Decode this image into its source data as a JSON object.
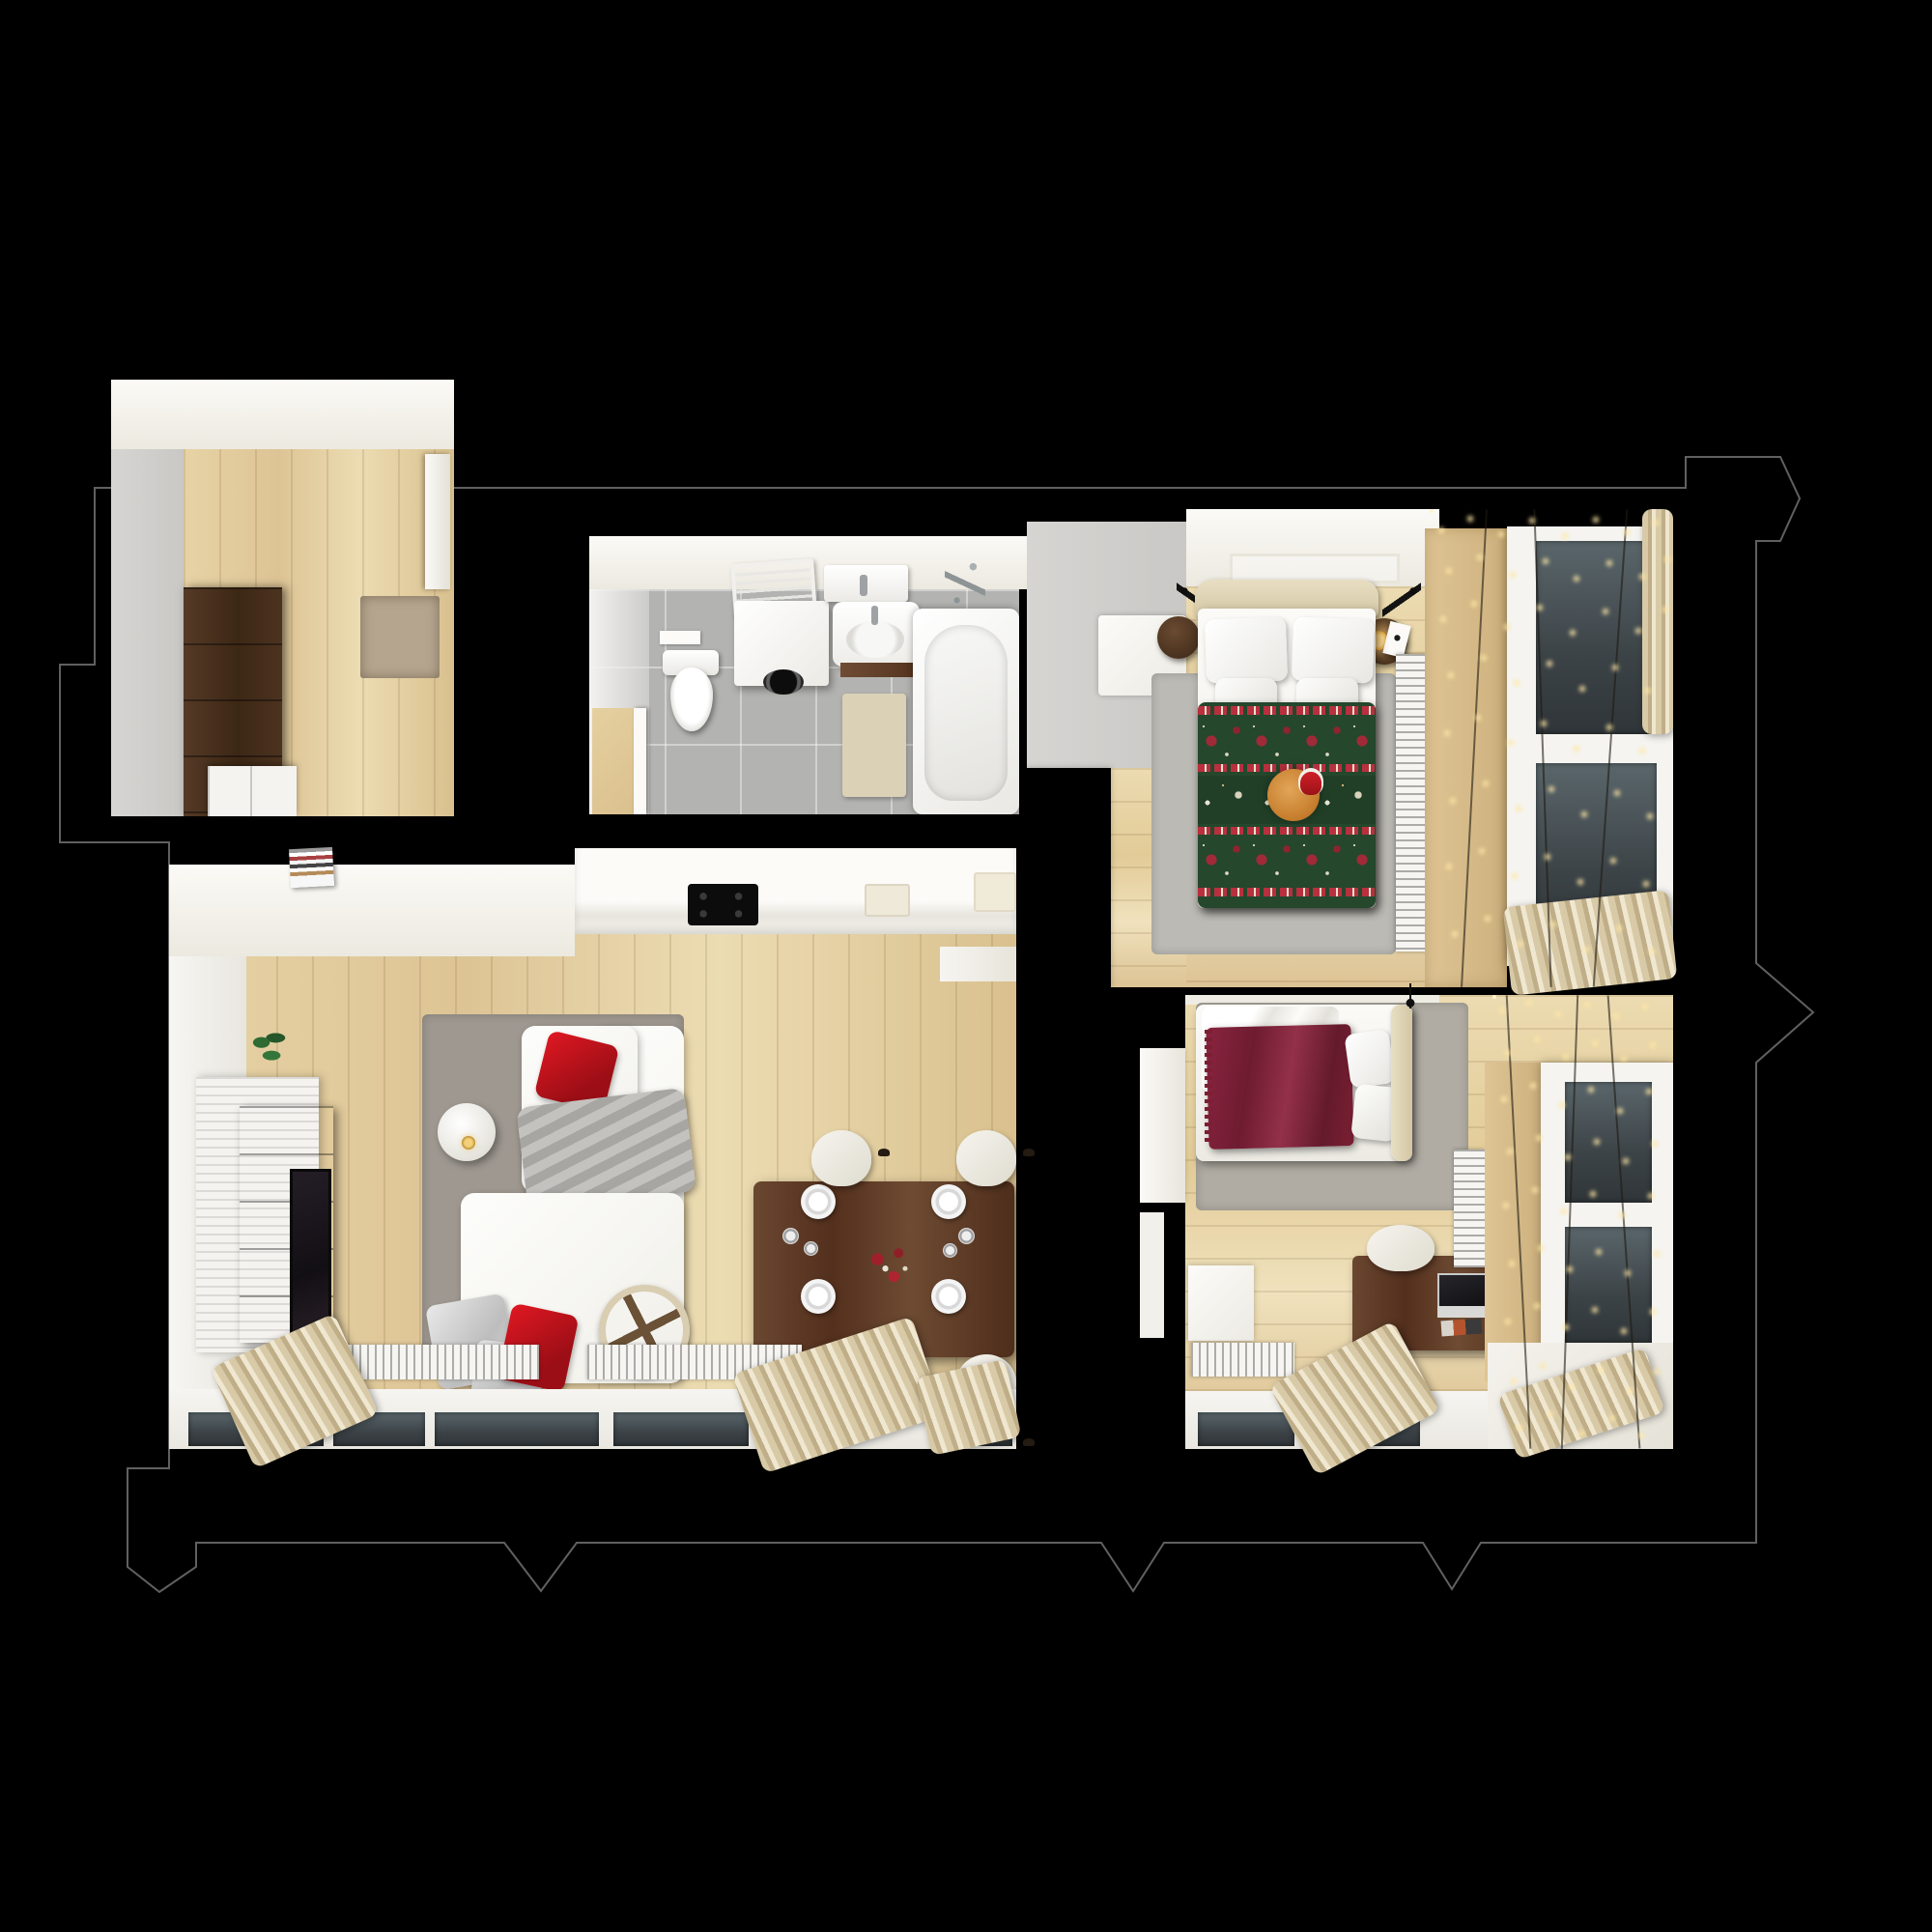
{
  "scene": {
    "type": "3d-floor-plan-top-down-render",
    "theme": "apartment interior with Christmas decor",
    "background_color": "#000000",
    "outline_color": "#606060"
  },
  "palette": {
    "wood_floor": "#e2cb97",
    "gray_tile": "#b3b3b1",
    "walnut_furniture": "#5d3e2a",
    "christmas_green": "#25472c",
    "christmas_red": "#a02a38",
    "burgundy_throw": "#7c1f33",
    "accent_red_pillow": "#c01020",
    "fairy_light_glow": "#ffe7a6",
    "cat_fur": "#d9913f"
  },
  "rooms": [
    {
      "id": "entry-hall",
      "label": "Entry hall",
      "objects": [
        "dark-wood-wardrobe",
        "shoe-cubbies",
        "doormat",
        "wood-floor",
        "gray-floor",
        "door"
      ]
    },
    {
      "id": "bathroom",
      "label": "Bathroom",
      "objects": [
        "toilet",
        "flush-plate",
        "towel-ladder",
        "washing-machine",
        "sink",
        "vanity-sink",
        "bathtub",
        "shower-fixture",
        "bath-mat",
        "gray-tile-floor",
        "door"
      ]
    },
    {
      "id": "living-kitchen",
      "label": "Living room / kitchen / dining",
      "objects": [
        "kitchen-counter",
        "black-cooktop",
        "kitchen-sink",
        "magazine-shelf",
        "tv-slat-wall",
        "tv-panel",
        "tv-screen",
        "plant",
        "gray-rug",
        "corner-sofa",
        "red-pillows",
        "silver-pillows",
        "gray-throw",
        "round-side-table",
        "gold-lamp",
        "decor-wheel",
        "dining-table",
        "plates",
        "glasses",
        "red-centerpiece",
        "four-chairs",
        "radiators",
        "windows",
        "curtains",
        "bedroom-door-threshold"
      ]
    },
    {
      "id": "bedroom-main",
      "label": "Main bedroom",
      "objects": [
        "double-bed",
        "headboard",
        "four-pillows",
        "green-christmas-blanket",
        "sleeping-cat-with-santa-hat",
        "wall-reading-lamps",
        "round-nightstands",
        "glowing-lamp",
        "gray-rug",
        "white-wardrobe",
        "dresser",
        "ceiling-light-frame",
        "radiator",
        "window",
        "string-lights",
        "curtains",
        "gray-dressing-floor"
      ]
    },
    {
      "id": "bedroom-second",
      "label": "Second bedroom",
      "objects": [
        "bed",
        "burgundy-throw",
        "white-pillows",
        "headboard",
        "black-lamp",
        "gray-rug",
        "desk",
        "laptop",
        "magazine",
        "gold-tray",
        "desk-chair",
        "white-wardrobe",
        "radiators",
        "window",
        "string-lights",
        "curtains",
        "open-door",
        "wall-frame"
      ]
    }
  ]
}
